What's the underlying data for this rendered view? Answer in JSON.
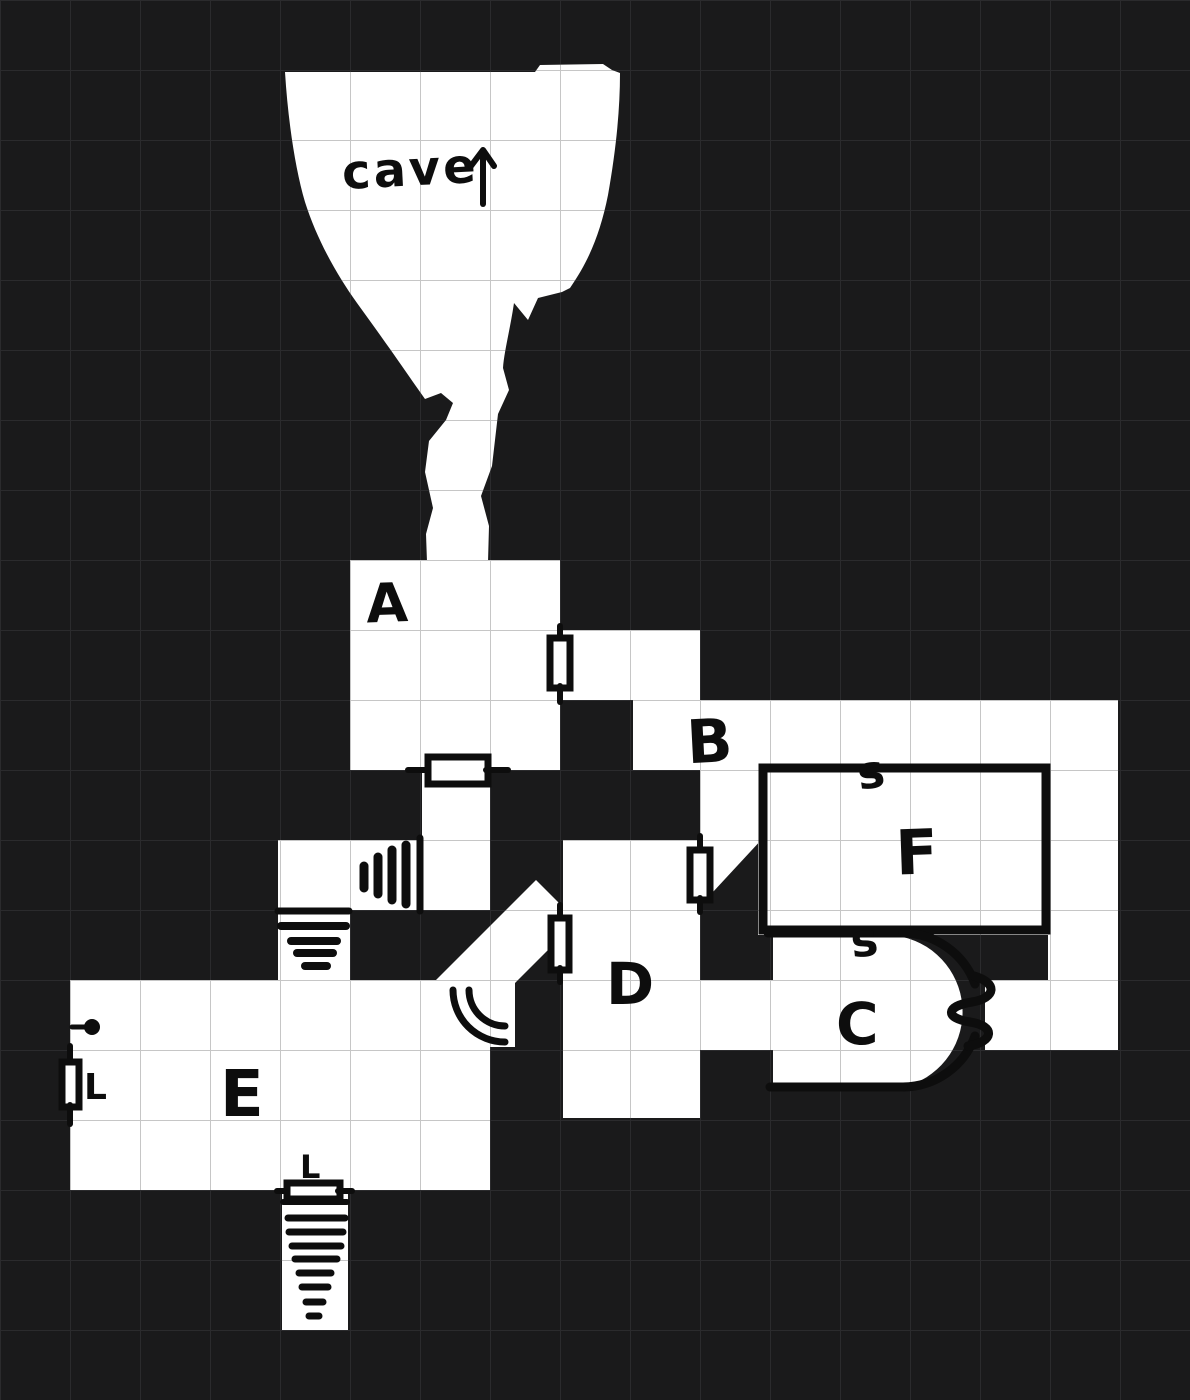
{
  "colors": {
    "background": "#1a1a1b",
    "grid_dark": "#2b2b2d",
    "floor": "#ffffff",
    "grid_light": "#c6c6c6",
    "ink": "#0d0d0d"
  },
  "cave": {
    "label": "cave",
    "arrow": "↑"
  },
  "rooms": [
    {
      "label": "A"
    },
    {
      "label": "B"
    },
    {
      "label": "C"
    },
    {
      "label": "D"
    },
    {
      "label": "E"
    },
    {
      "label": "F"
    }
  ],
  "marks": {
    "secret_door_top": "s",
    "secret_door_bottom": "s",
    "locked_door_west": "L",
    "locked_door_south": "L"
  }
}
